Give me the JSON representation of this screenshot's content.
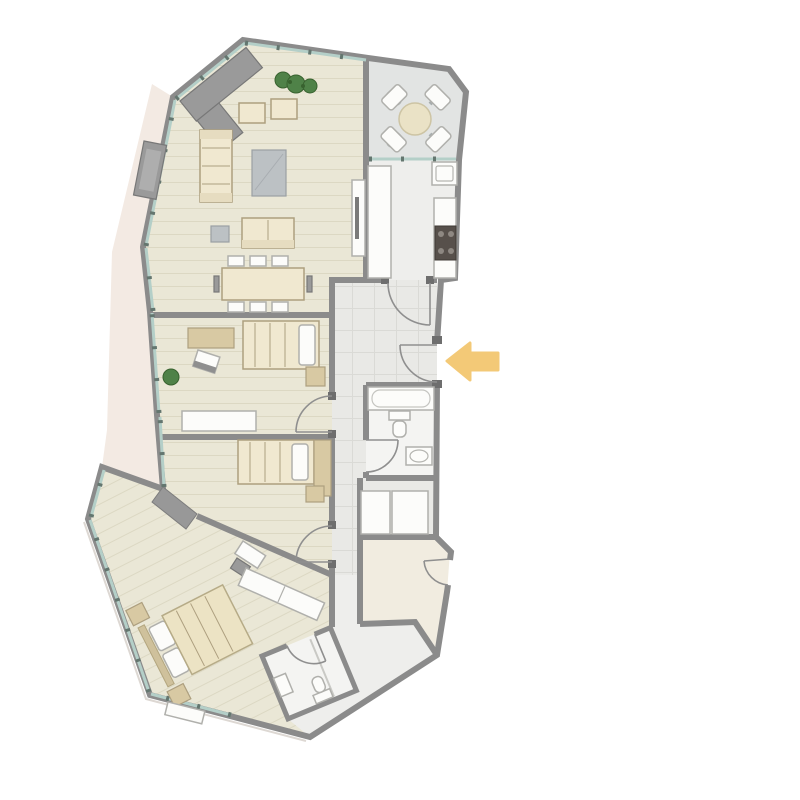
{
  "meta": {
    "title": "apartment-floor-plan",
    "image_type": "architectural floor plan, top-down view, no text labels",
    "canvas_px": "800x800"
  },
  "palette": {
    "background": "#ffffff",
    "wall": "#8b8b8b",
    "wall_dark": "#6e6e6e",
    "door_line": "#8f8f8f",
    "window": "#b4cfc8",
    "window_tick": "#64766f",
    "floor_wood": "#eae7d6",
    "floor_wood_stripe": "#dcd8c3",
    "floor_tile": "#e9e9e6",
    "floor_tile_line": "#dadad6",
    "floor_bath": "#f4f4f2",
    "floor_balcony": "#e2e4e3",
    "floor_kitchen": "#eeeeec",
    "floor_plain": "#f1ece0",
    "exterior_band": "#f3eae3",
    "exterior_line": "#ddd8d3",
    "furniture_beige": "#f0e8d0",
    "furniture_beige_dark": "#d8c9a3",
    "furniture_border": "#ad9f7f",
    "furniture_white": "#fcfcfa",
    "furniture_white_border": "#b0b0ac",
    "furniture_gray": "#9a9a9a",
    "furniture_gray_border": "#787878",
    "table_gray": "#bcc1c4",
    "stove": "#57504b",
    "stove_burner": "#8e8882",
    "plant_green": "#4f8248",
    "plant_dark": "#38622f",
    "arrow_orange": "#f3c56d"
  },
  "plan": {
    "rooms": [
      {
        "id": "living-room",
        "floor": "wood-plank"
      },
      {
        "id": "balcony",
        "floor": "tile"
      },
      {
        "id": "kitchen",
        "floor": "tile"
      },
      {
        "id": "entrance-hall",
        "floor": "tile-grid"
      },
      {
        "id": "corridor",
        "floor": "tile-grid"
      },
      {
        "id": "bedroom-1",
        "floor": "wood-plank"
      },
      {
        "id": "bedroom-2",
        "floor": "wood-plank"
      },
      {
        "id": "bathroom",
        "floor": "stone"
      },
      {
        "id": "storage-closets",
        "floor": "stone"
      },
      {
        "id": "utility-room",
        "floor": "plain"
      },
      {
        "id": "master-bedroom",
        "floor": "wood-plank-diagonal"
      },
      {
        "id": "ensuite-bathroom",
        "floor": "stone"
      }
    ],
    "furniture": {
      "living_room": [
        "corner-sofa",
        "wall-unit",
        "sofa",
        "coffee-table",
        "armchair",
        "armchair",
        "side-table",
        "loveseat",
        "dining-table",
        "dining-chairs",
        "tv-sideboard",
        "plants"
      ],
      "balcony": [
        "round-table",
        "four-chairs"
      ],
      "kitchen": [
        "counter-left",
        "counter-right",
        "stove-4-burner",
        "sink-unit"
      ],
      "bedroom_1": [
        "desk",
        "desk-chair",
        "single-bed",
        "nightstand",
        "sideboard",
        "plant"
      ],
      "bedroom_2": [
        "single-bed",
        "wardrobe",
        "nightstand",
        "desk-chair"
      ],
      "master_bedroom": [
        "double-bed",
        "nightstand",
        "nightstand",
        "wardrobe",
        "desk",
        "chair",
        "bench"
      ],
      "bathroom": [
        "bathtub",
        "toilet",
        "sink"
      ],
      "ensuite_bathroom": [
        "shower",
        "sink",
        "toilet"
      ]
    },
    "doors": [
      "entrance-door",
      "kitchen-door",
      "bedroom-1-door",
      "bedroom-2-door",
      "bathroom-door",
      "utility-room-door",
      "ensuite-door"
    ],
    "indicators": {
      "entrance_arrow": {
        "shape": "left-arrow",
        "color": "#f3c56d",
        "meaning": "main entrance"
      }
    }
  }
}
